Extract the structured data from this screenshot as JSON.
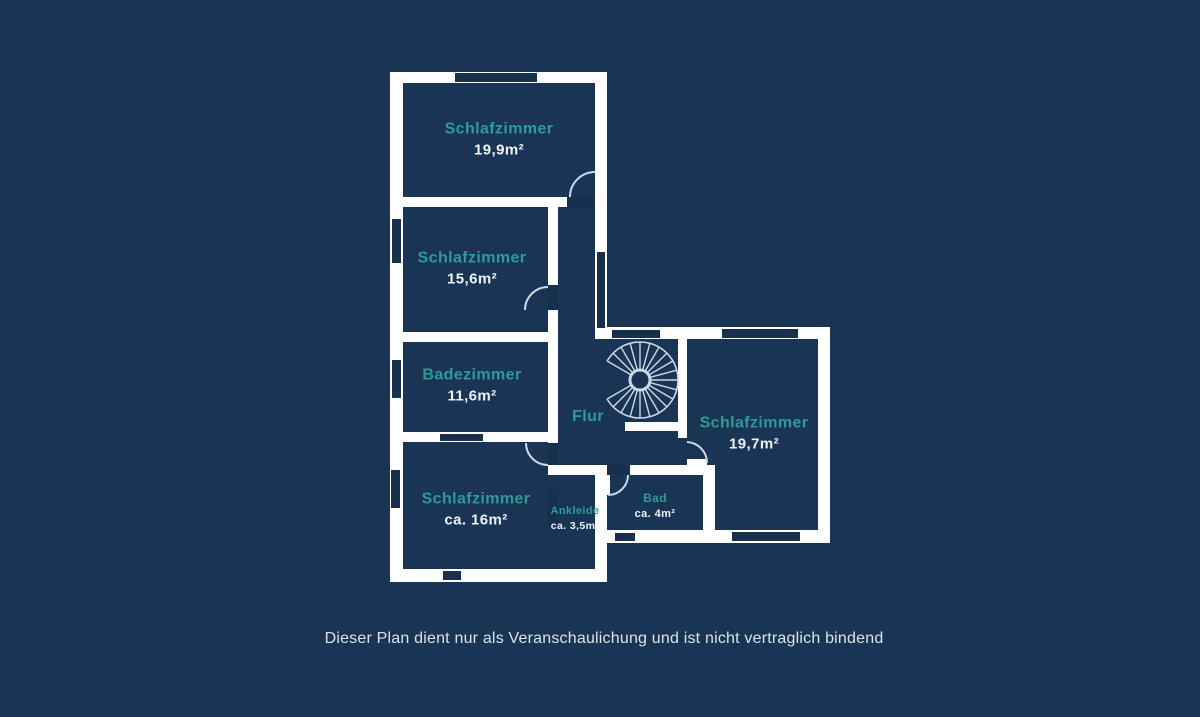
{
  "page": {
    "disclaimer": "Dieser Plan dient nur als Veranschaulichung und ist nicht vertraglich bindend"
  },
  "colors": {
    "background": "#1a3455",
    "room_fill": "#17304e",
    "wall": "#ffffff",
    "accent_teal": "#2d9b96",
    "area_text": "#eef2f6",
    "disclaimer_text": "#dce2ea",
    "thin_line": "#ccd8e4"
  },
  "floorplan": {
    "rooms": [
      {
        "id": "schlafzimmer-nw",
        "name": "Schlafzimmer",
        "area": "19,9m²",
        "cx": 499,
        "cy": 140,
        "size": "lg"
      },
      {
        "id": "schlafzimmer-w",
        "name": "Schlafzimmer",
        "area": "15,6m²",
        "cx": 472,
        "cy": 269,
        "size": "lg"
      },
      {
        "id": "badezimmer",
        "name": "Badezimmer",
        "area": "11,6m²",
        "cx": 472,
        "cy": 386,
        "size": "lg"
      },
      {
        "id": "schlafzimmer-sw",
        "name": "Schlafzimmer",
        "area": "ca. 16m²",
        "cx": 476,
        "cy": 510,
        "size": "lg"
      },
      {
        "id": "ankleide",
        "name": "Ankleide",
        "area": "ca. 3,5m²",
        "cx": 575,
        "cy": 519,
        "size": "xs"
      },
      {
        "id": "bad",
        "name": "Bad",
        "area": "ca. 4m²",
        "cx": 655,
        "cy": 506,
        "size": "sm"
      },
      {
        "id": "schlafzimmer-e",
        "name": "Schlafzimmer",
        "area": "19,7m²",
        "cx": 754,
        "cy": 434,
        "size": "lg"
      },
      {
        "id": "flur",
        "name": "Flur",
        "area": "",
        "cx": 588,
        "cy": 417,
        "size": "lg"
      }
    ],
    "walls": [
      {
        "id": "wall-outer-left",
        "x": 390,
        "y": 72,
        "w": 13,
        "h": 510
      },
      {
        "id": "wall-outer-top",
        "x": 390,
        "y": 72,
        "w": 217,
        "h": 11
      },
      {
        "id": "wall-outer-right-up",
        "x": 595,
        "y": 72,
        "w": 12,
        "h": 267
      },
      {
        "id": "wall-outer-bottom-a",
        "x": 390,
        "y": 569,
        "w": 217,
        "h": 13
      },
      {
        "id": "wall-outer-top-b",
        "x": 595,
        "y": 327,
        "w": 235,
        "h": 12
      },
      {
        "id": "wall-outer-right-b",
        "x": 818,
        "y": 327,
        "w": 12,
        "h": 216
      },
      {
        "id": "wall-outer-bottom-b",
        "x": 607,
        "y": 530,
        "w": 223,
        "h": 13
      },
      {
        "id": "wall-step-right",
        "x": 595,
        "y": 465,
        "w": 12,
        "h": 117
      },
      {
        "id": "wall-flur-south",
        "x": 548,
        "y": 465,
        "w": 167,
        "h": 10
      },
      {
        "id": "wall-nw-rooms",
        "x": 403,
        "y": 197,
        "w": 204,
        "h": 10
      },
      {
        "id": "wall-w-bade",
        "x": 390,
        "y": 332,
        "w": 158,
        "h": 10
      },
      {
        "id": "wall-bade-sw",
        "x": 390,
        "y": 432,
        "w": 158,
        "h": 10
      },
      {
        "id": "wall-corridor-west",
        "x": 548,
        "y": 197,
        "w": 10,
        "h": 278
      },
      {
        "id": "wall-flur-east",
        "x": 678,
        "y": 330,
        "w": 9,
        "h": 108
      },
      {
        "id": "wall-bad-east",
        "x": 703,
        "y": 467,
        "w": 12,
        "h": 63
      },
      {
        "id": "stair-landing",
        "x": 625,
        "y": 422,
        "w": 60,
        "h": 9
      }
    ],
    "door_leaves": [
      {
        "id": "door-leaf-schlafzimmer-e",
        "x": 687,
        "y": 459,
        "w": 20,
        "h": 8
      },
      {
        "id": "door-leaf-bad",
        "x": 605,
        "y": 475,
        "w": 5,
        "h": 20
      }
    ],
    "openings": [
      {
        "id": "window-top-nw",
        "x": 455,
        "y": 73,
        "w": 82,
        "h": 9
      },
      {
        "id": "window-left-w",
        "x": 392,
        "y": 219,
        "w": 9,
        "h": 44
      },
      {
        "id": "window-left-bade",
        "x": 392,
        "y": 360,
        "w": 9,
        "h": 38
      },
      {
        "id": "window-left-sw",
        "x": 391,
        "y": 470,
        "w": 9,
        "h": 38
      },
      {
        "id": "window-bottom-sw",
        "x": 443,
        "y": 571,
        "w": 18,
        "h": 9
      },
      {
        "id": "window-corridor-east",
        "x": 597,
        "y": 252,
        "w": 8,
        "h": 76
      },
      {
        "id": "window-top-flur",
        "x": 612,
        "y": 330,
        "w": 48,
        "h": 8
      },
      {
        "id": "window-top-e",
        "x": 722,
        "y": 329,
        "w": 76,
        "h": 9
      },
      {
        "id": "window-bottom-bad",
        "x": 615,
        "y": 533,
        "w": 20,
        "h": 8
      },
      {
        "id": "window-bottom-e",
        "x": 732,
        "y": 532,
        "w": 68,
        "h": 9
      },
      {
        "id": "opening-bade",
        "x": 440,
        "y": 434,
        "w": 43,
        "h": 7
      },
      {
        "id": "opening-ankleide",
        "x": 548,
        "y": 490,
        "w": 10,
        "h": 37
      },
      {
        "id": "door-gap-nw",
        "x": 567,
        "y": 197,
        "w": 28,
        "h": 10
      },
      {
        "id": "door-gap-w",
        "x": 548,
        "y": 285,
        "w": 10,
        "h": 25
      },
      {
        "id": "door-gap-sw",
        "x": 548,
        "y": 443,
        "w": 10,
        "h": 22
      },
      {
        "id": "door-gap-bad",
        "x": 607,
        "y": 465,
        "w": 23,
        "h": 10
      }
    ],
    "door_arcs": [
      {
        "id": "door-arc-schlafzimmer-nw",
        "d": "M 570 197 A 25 25 0 0 1 595 172"
      },
      {
        "id": "door-arc-schlafzimmer-w",
        "d": "M 525 310 A 23 23 0 0 1 548 287"
      },
      {
        "id": "door-arc-schlafzimmer-sw",
        "d": "M 526 443 A 22 22 0 0 0 548 465"
      },
      {
        "id": "door-arc-schlafzimmer-e",
        "d": "M 707 463 A 21 21 0 0 0 687 442"
      },
      {
        "id": "door-arc-bad",
        "d": "M 628 475 A 20 20 0 0 1 608 495"
      }
    ],
    "stair": {
      "cx": 640,
      "cy": 380,
      "r_outer": 38,
      "r_hub": 10,
      "spoke_start_deg": 210,
      "spoke_end_deg": 510,
      "spoke_step_deg": 15,
      "outer_arc_path": "M 607.1 361 A 38 38 0 1 1 607.1 399"
    }
  }
}
